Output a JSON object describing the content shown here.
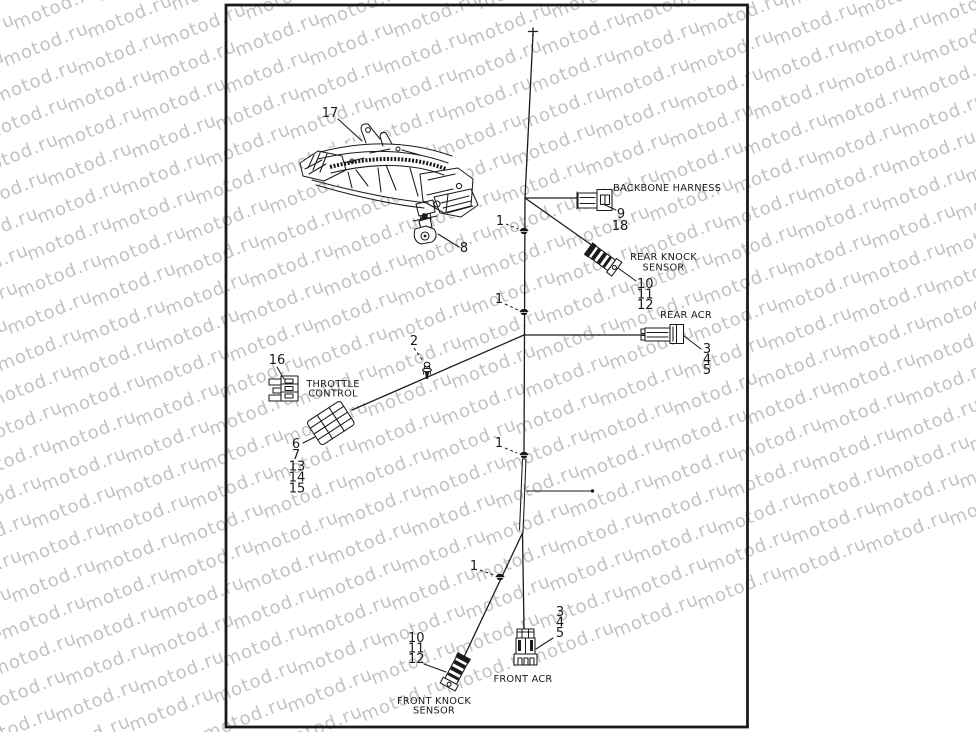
{
  "watermark": {
    "text": "motod.ru"
  },
  "colors": {
    "background": "#ffffff",
    "line": "#1a1a1a",
    "watermark": "#c2c2c2"
  },
  "diagram": {
    "callouts": {
      "bracket": "17",
      "clamp": "8",
      "pin": "2",
      "throttle_connector": "16",
      "clips": [
        "1",
        "1",
        "1",
        "1"
      ]
    },
    "backbone_harness": {
      "label": "BACKBONE HARNESS",
      "parts": [
        "9",
        "18"
      ]
    },
    "rear_knock_sensor": {
      "label_line1": "REAR KNOCK",
      "label_line2": "SENSOR",
      "parts": [
        "10",
        "11",
        "12"
      ]
    },
    "rear_acr": {
      "label": "REAR ACR",
      "parts": [
        "3",
        "4",
        "5"
      ]
    },
    "throttle_control": {
      "label_line1": "THROTTLE",
      "label_line2": "CONTROL",
      "parts": [
        "6",
        "7",
        "13",
        "14",
        "15"
      ]
    },
    "front_knock_sensor": {
      "label_line1": "FRONT KNOCK",
      "label_line2": "SENSOR",
      "parts": [
        "10",
        "11",
        "12"
      ]
    },
    "front_acr": {
      "label": "FRONT ACR",
      "parts": [
        "3",
        "4",
        "5"
      ]
    }
  }
}
